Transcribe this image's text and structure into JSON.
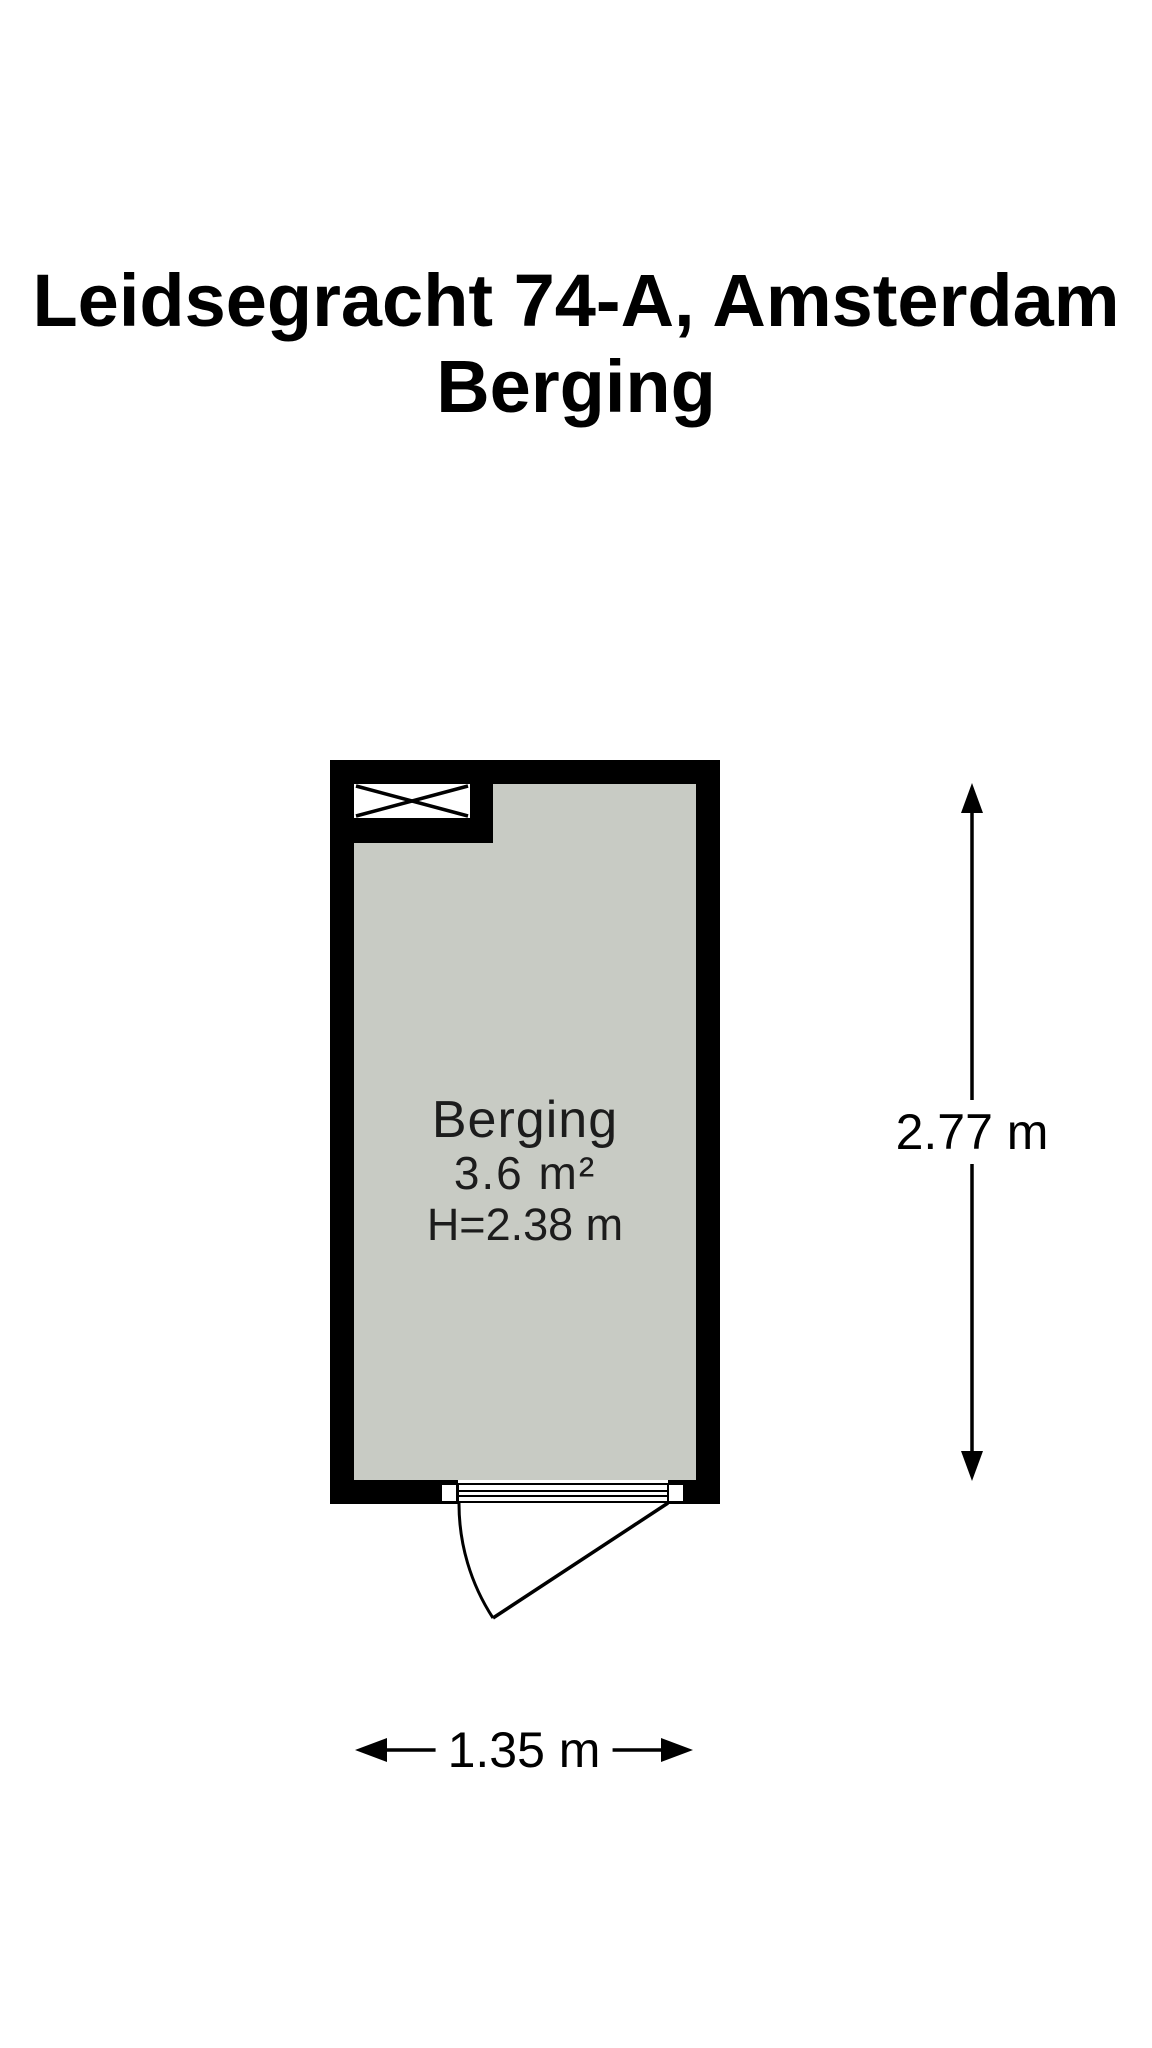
{
  "title": {
    "line1": "Leidsegracht 74-A, Amsterdam",
    "line2": "Berging"
  },
  "room": {
    "name": "Berging",
    "area": "3.6 m²",
    "ceiling_height": "H=2.38 m"
  },
  "dimensions": {
    "height_label": "2.77 m",
    "width_label": "1.35 m"
  },
  "symbols": {
    "shaft": "crossed-box-shaft",
    "door": "single-swing-door-outward",
    "vertical_dimension": "double-headed-arrow-vertical",
    "horizontal_dimension": "double-headed-arrow-horizontal"
  },
  "colors": {
    "wall": "#000000",
    "floor": "#c8cbc4",
    "background": "#ffffff",
    "title_text": "#000000",
    "label_text": "#1c1c1c"
  }
}
